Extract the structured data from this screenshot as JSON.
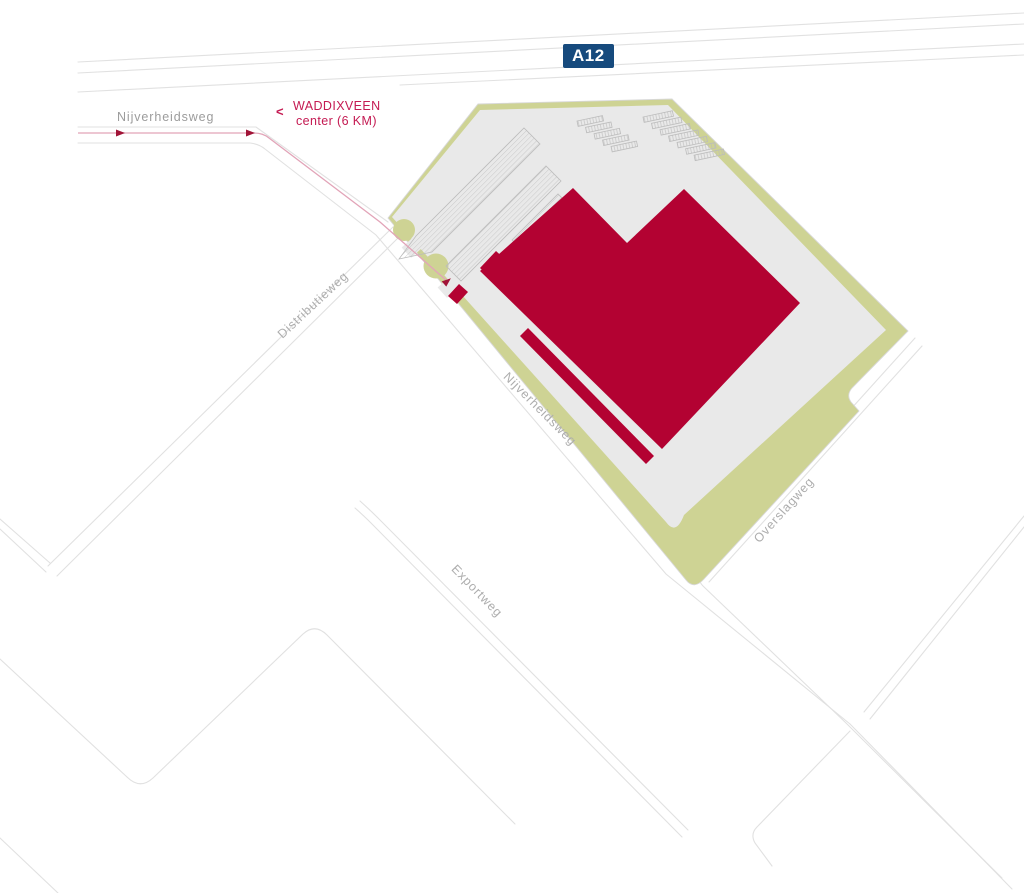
{
  "map": {
    "highway_badge": "A12",
    "labels": {
      "nijverheidsweg_west": "Nijverheidsweg",
      "waddixveen_line1": "WADDIXVEEN",
      "waddixveen_line2": "center (6 KM)",
      "waddixveen_chevron": "<",
      "distributieweg": "Distributieweg",
      "nijverheidsweg_diagonal": "Nijverheidsweg",
      "exportweg": "Exportweg",
      "overslagweg": "Overslagweg"
    },
    "colors": {
      "building_red": "#b30232",
      "site_green": "#ced394",
      "paved_gray": "#e9e9e9",
      "road_line": "#e1e1e1",
      "site_edge_line": "#d8d8d8",
      "parking_line": "#bcbcbc",
      "route_line": "#e2a4b8",
      "route_arrow": "#a11337",
      "badge_bg": "#164a7d",
      "badge_text_color": "#ffffff",
      "accent_red": "#c41a52",
      "label_gray": "#9c9c9c",
      "label_gray_light": "#adadad"
    }
  }
}
